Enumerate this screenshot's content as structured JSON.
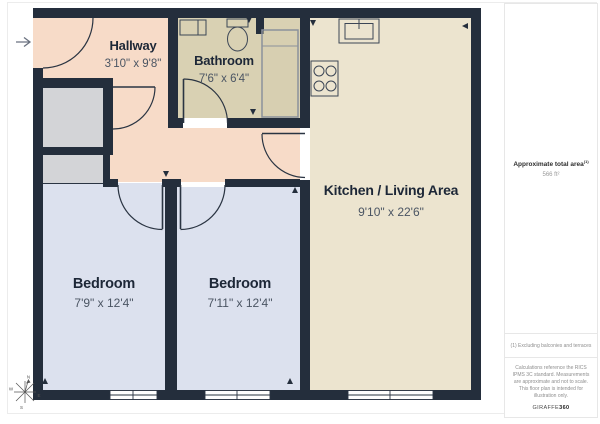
{
  "rooms": [
    {
      "id": "hallway",
      "name": "Hallway",
      "dims": "3'10\" x 9'8\""
    },
    {
      "id": "bathroom",
      "name": "Bathroom",
      "dims": "7'6\" x 6'4\""
    },
    {
      "id": "kitchen_living",
      "name": "Kitchen / Living Area",
      "dims": "9'10\" x 22'6\""
    },
    {
      "id": "bedroom_1",
      "name": "Bedroom",
      "dims": "7'9\" x 12'4\""
    },
    {
      "id": "bedroom_2",
      "name": "Bedroom",
      "dims": "7'11\" x 12'4\""
    }
  ],
  "sidebar": {
    "total_area_label": "Approximate total area",
    "total_area_superscript": "(1)",
    "total_area_value": "566 ft²",
    "footnote": "(1) Excluding balconies and terraces",
    "disclaimer": "Calculations reference the RICS IPMS 3C standard. Measurements are approximate and not to scale. This floor plan is intended for illustration only.",
    "brand": "GIRAFFE",
    "brand_bold": "360"
  },
  "compass": {
    "letters": [
      "N",
      "E",
      "S",
      "W"
    ]
  },
  "colors": {
    "wall": "#242e3c",
    "hallway": "#f7dbc8",
    "bathroom": "#d9d1b3",
    "kitchen_living": "#ece4cf",
    "bedroom": "#dce1ee",
    "closet": "#d3d4d7",
    "shower_fill": "#d5cdae",
    "shower_stroke": "#8b919b",
    "fixture": "#3c4656",
    "door": "#2a3442",
    "window": "#ffffff",
    "room_name": "#1d2737",
    "room_dims": "#4b5563",
    "entry_arrow": "#6b7280",
    "compass": "#555555"
  }
}
